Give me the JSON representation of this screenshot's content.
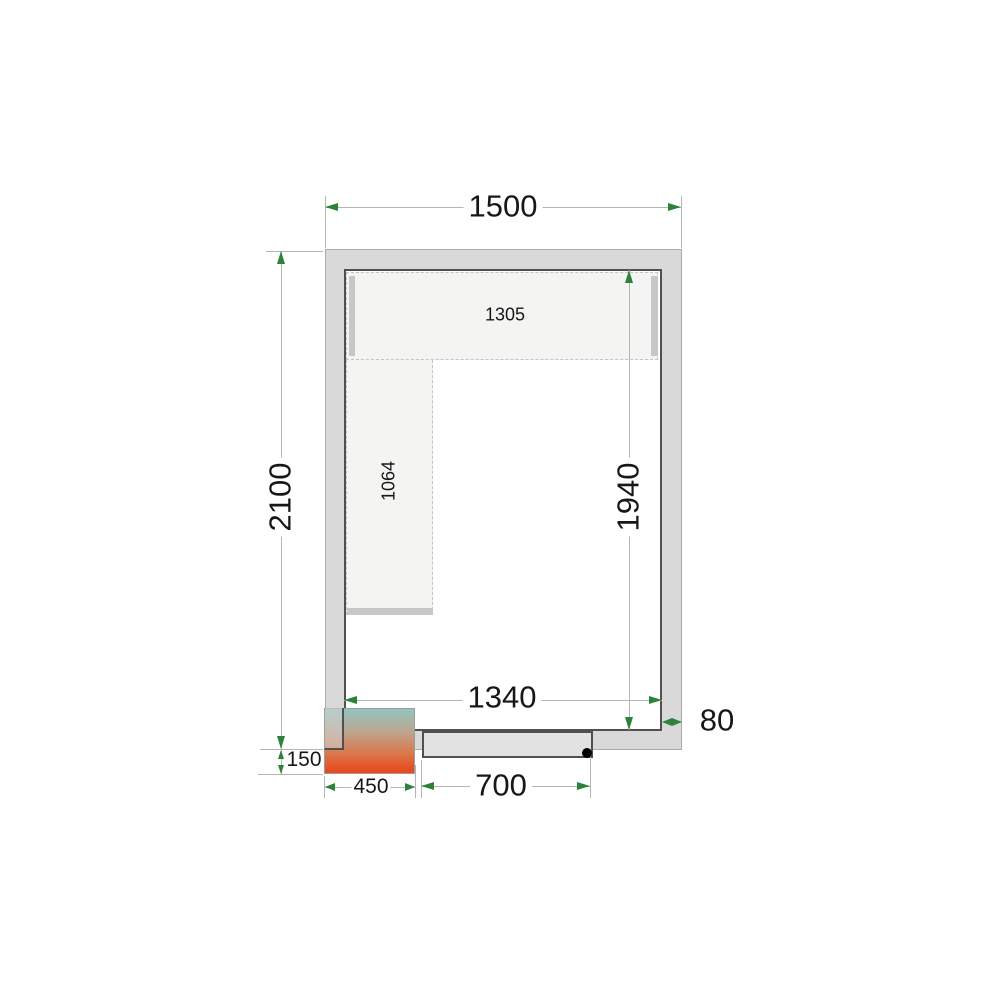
{
  "diagram": {
    "description": "Cold room floor plan, top view, with shelving, door and through-wall cooling unit",
    "labels": {
      "outer_width": "1500",
      "outer_depth": "2100",
      "inner_width": "1340",
      "inner_depth": "1940",
      "wall_thickness": "80",
      "door_opening": "700",
      "cooling_unit_width": "450",
      "cooling_unit_protrusion": "150",
      "shelf_top_length": "1305",
      "shelf_left_length": "1064"
    },
    "colors": {
      "wall_fill": "#d9d9d9",
      "wall_border": "#505050",
      "outer_edge": "#ababab",
      "door_fill": "#e2e2e2",
      "shelf_fill": "#f4f4f3",
      "shelf_rail": "#c7c7c7",
      "dim_line": "#b5b5b5",
      "arrow_green": "#2b8339",
      "text": "#171717",
      "unit_gradient_top": "#92c5c0",
      "unit_gradient_mid": "#d97a4e",
      "unit_gradient_bottom": "#e74b1e",
      "hinge_dot": "#000000"
    }
  }
}
